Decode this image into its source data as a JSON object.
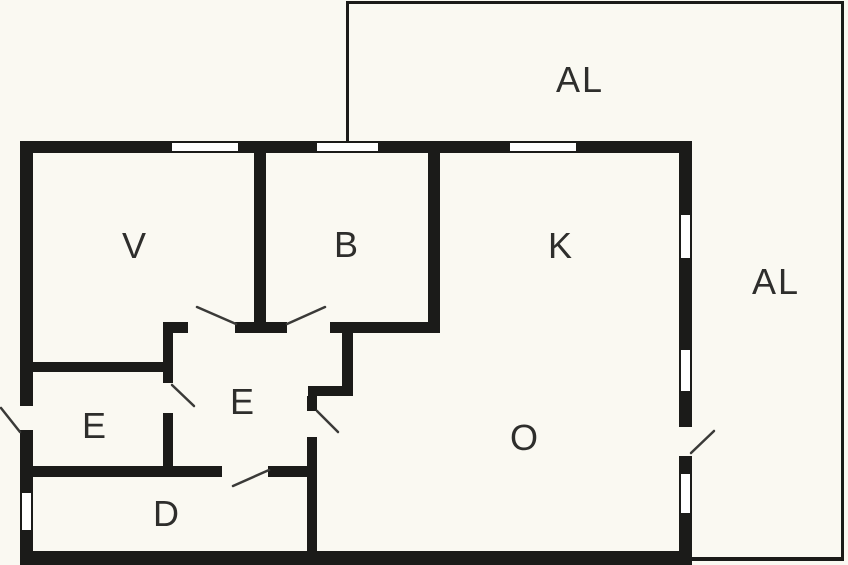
{
  "plan": {
    "type": "floor-plan",
    "rooms": [
      {
        "id": "al-top",
        "label": "AL"
      },
      {
        "id": "al-right",
        "label": "AL"
      },
      {
        "id": "v",
        "label": "V"
      },
      {
        "id": "b",
        "label": "B"
      },
      {
        "id": "k",
        "label": "K"
      },
      {
        "id": "o",
        "label": "O"
      },
      {
        "id": "e-hall",
        "label": "E"
      },
      {
        "id": "e-entry",
        "label": "E"
      },
      {
        "id": "d",
        "label": "D"
      }
    ],
    "counts": {
      "windows": 7,
      "interior_doors": 5,
      "exterior_doors": 2
    }
  },
  "colors": {
    "background": "#faf9f2",
    "wall": "#1b1b19",
    "label": "#2e2e2c",
    "window_fill": "#ffffff",
    "door_swing": "#3a3a38"
  }
}
